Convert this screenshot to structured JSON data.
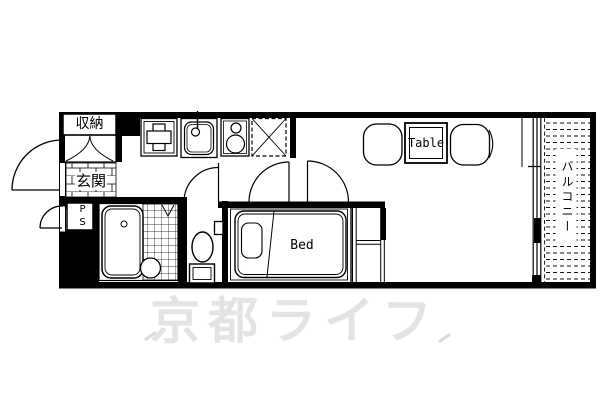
{
  "plan": {
    "rooms": {
      "closet_label": "収納",
      "entrance_label": "玄関",
      "pipe_space_label": "PS",
      "balcony_label": "バルコニー"
    },
    "furniture": {
      "table_label": "Table",
      "bed_label": "Bed"
    },
    "watermark_text": "京都ライフ",
    "colors": {
      "line": "#000000",
      "watermark": "#e4e4e4",
      "background": "#ffffff"
    }
  }
}
